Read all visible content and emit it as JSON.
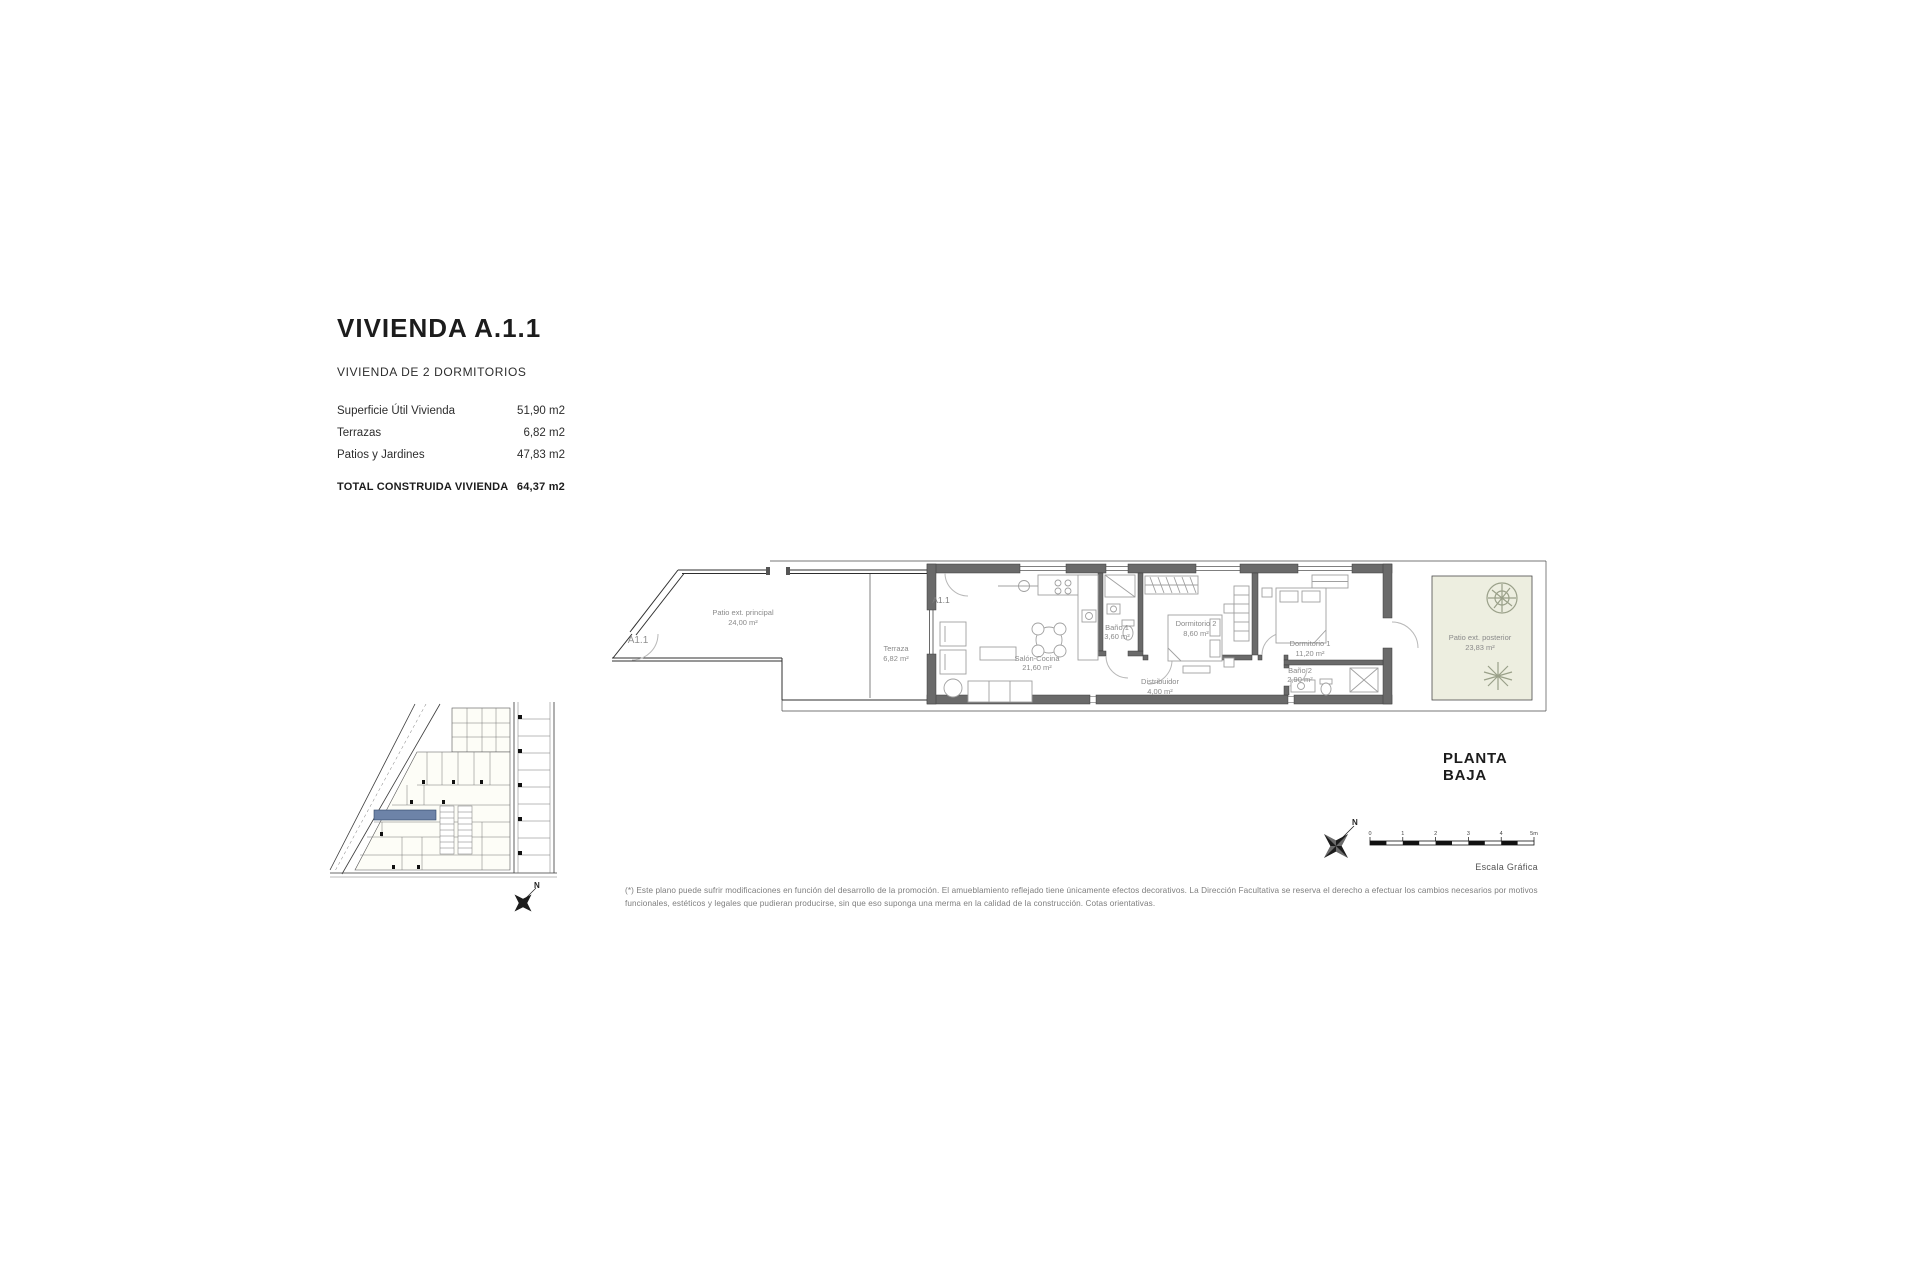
{
  "title_block": {
    "title": "VIVIENDA A.1.1",
    "subtitle": "VIVIENDA DE 2 DORMITORIOS",
    "rows": [
      {
        "label": "Superficie Útil Vivienda",
        "value": "51,90 m2"
      },
      {
        "label": "Terrazas",
        "value": "6,82 m2"
      },
      {
        "label": "Patios y Jardines",
        "value": "47,83 m2"
      }
    ],
    "total_row": {
      "label": "TOTAL CONSTRUIDA VIVIENDA",
      "value": "64,37 m2"
    }
  },
  "floor_plan": {
    "floor_label": "PLANTA BAJA",
    "unit_gate_label": "A1.1",
    "unit_entrance_label": "A1.1",
    "rooms": [
      {
        "name": "Patio ext. principal",
        "area": "24,00 m²"
      },
      {
        "name": "Terraza",
        "area": "6,82 m²"
      },
      {
        "name": "Salón-Cocina",
        "area": "21,60 m²"
      },
      {
        "name": "Baño 1",
        "area": "3,60 m²"
      },
      {
        "name": "Distribuidor",
        "area": "4,00 m²"
      },
      {
        "name": "Dormitorio 2",
        "area": "8,60 m²"
      },
      {
        "name": "Dormitorio 1",
        "area": "11,20 m²"
      },
      {
        "name": "Baño 2",
        "area": "2,90 m²"
      },
      {
        "name": "Patio ext. posterior",
        "area": "23,83 m²"
      }
    ]
  },
  "scale_bar": {
    "caption": "Escala Gráfica",
    "tick_labels": [
      "0",
      "1",
      "2",
      "3",
      "4",
      "5m"
    ]
  },
  "compass": {
    "north_label": "N"
  },
  "key_plan": {
    "north_label": "N"
  },
  "disclaimer": "(*) Este plano puede sufrir modificaciones en función del desarrollo de la promoción. El amueblamiento reflejado tiene únicamente efectos decorativos. La Dirección Facultativa se reserva el derecho a efectuar los cambios necesarios por motivos funcionales, estéticos y legales que pudieran producirse, sin que eso suponga una merma en la calidad de la construcción. Cotas orientativas.",
  "colors": {
    "wall": "#6a6a6a",
    "patio_fill": "#edeee0",
    "highlight_unit": "#6d83a8",
    "label_gray": "#8a8a8a"
  }
}
